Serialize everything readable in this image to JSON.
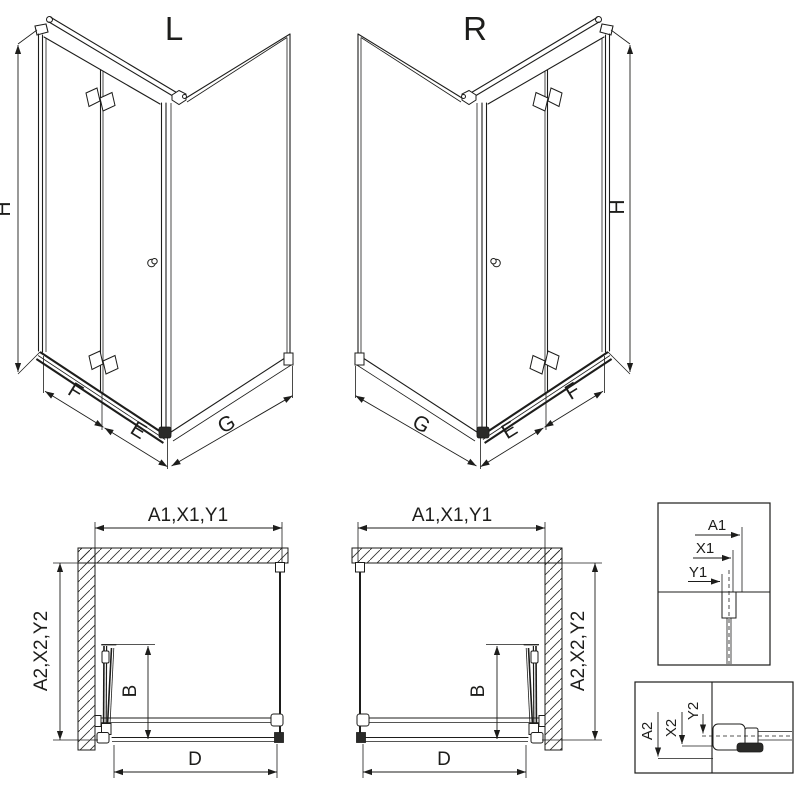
{
  "drawing": {
    "background": "#ffffff",
    "ink": "#1d1d1b",
    "iso_left": {
      "title": "L",
      "height_label": "H",
      "fixed_panel_label": "F",
      "door_panel_label": "E",
      "side_panel_label": "G"
    },
    "iso_right": {
      "title": "R",
      "height_label": "H",
      "fixed_panel_label": "F",
      "door_panel_label": "E",
      "side_panel_label": "G"
    },
    "plan_left": {
      "width_label": "A1,X1,Y1",
      "depth_label": "A2,X2,Y2",
      "door_fold_label": "B",
      "entry_label": "D"
    },
    "plan_right": {
      "width_label": "A1,X1,Y1",
      "depth_label": "A2,X2,Y2",
      "door_fold_label": "B",
      "entry_label": "D"
    },
    "detail_wall_profile": {
      "labels": [
        "A1",
        "X1",
        "Y1"
      ]
    },
    "detail_bottom_profile": {
      "labels": [
        "A2",
        "X2",
        "Y2"
      ]
    }
  }
}
